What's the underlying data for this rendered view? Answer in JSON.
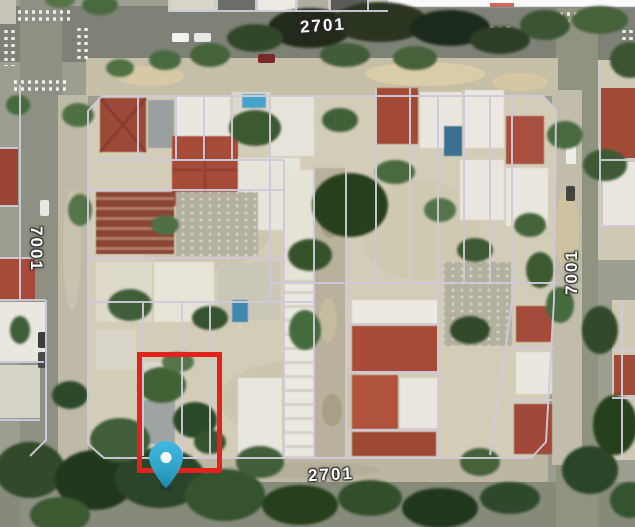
{
  "window": {
    "kind": "aerial-cadastral-map-view",
    "width": 635,
    "height": 527
  },
  "map": {
    "imagery": "satellite-photo-residential-city-block",
    "street_labels": {
      "top": "2701",
      "bottom": "2701",
      "left": "7001",
      "right": "7001"
    },
    "overlay": {
      "parcel_line_color": "#cfcadb"
    },
    "selection_rectangle": {
      "color": "#e0231d",
      "x": 137,
      "y": 352,
      "width": 85,
      "height": 119
    },
    "location_marker": {
      "kind": "map-pin",
      "fill": "#38b0d6",
      "tip_fill": "#1f86a8",
      "dot": "#ffffff",
      "x": 166,
      "y": 471
    }
  }
}
